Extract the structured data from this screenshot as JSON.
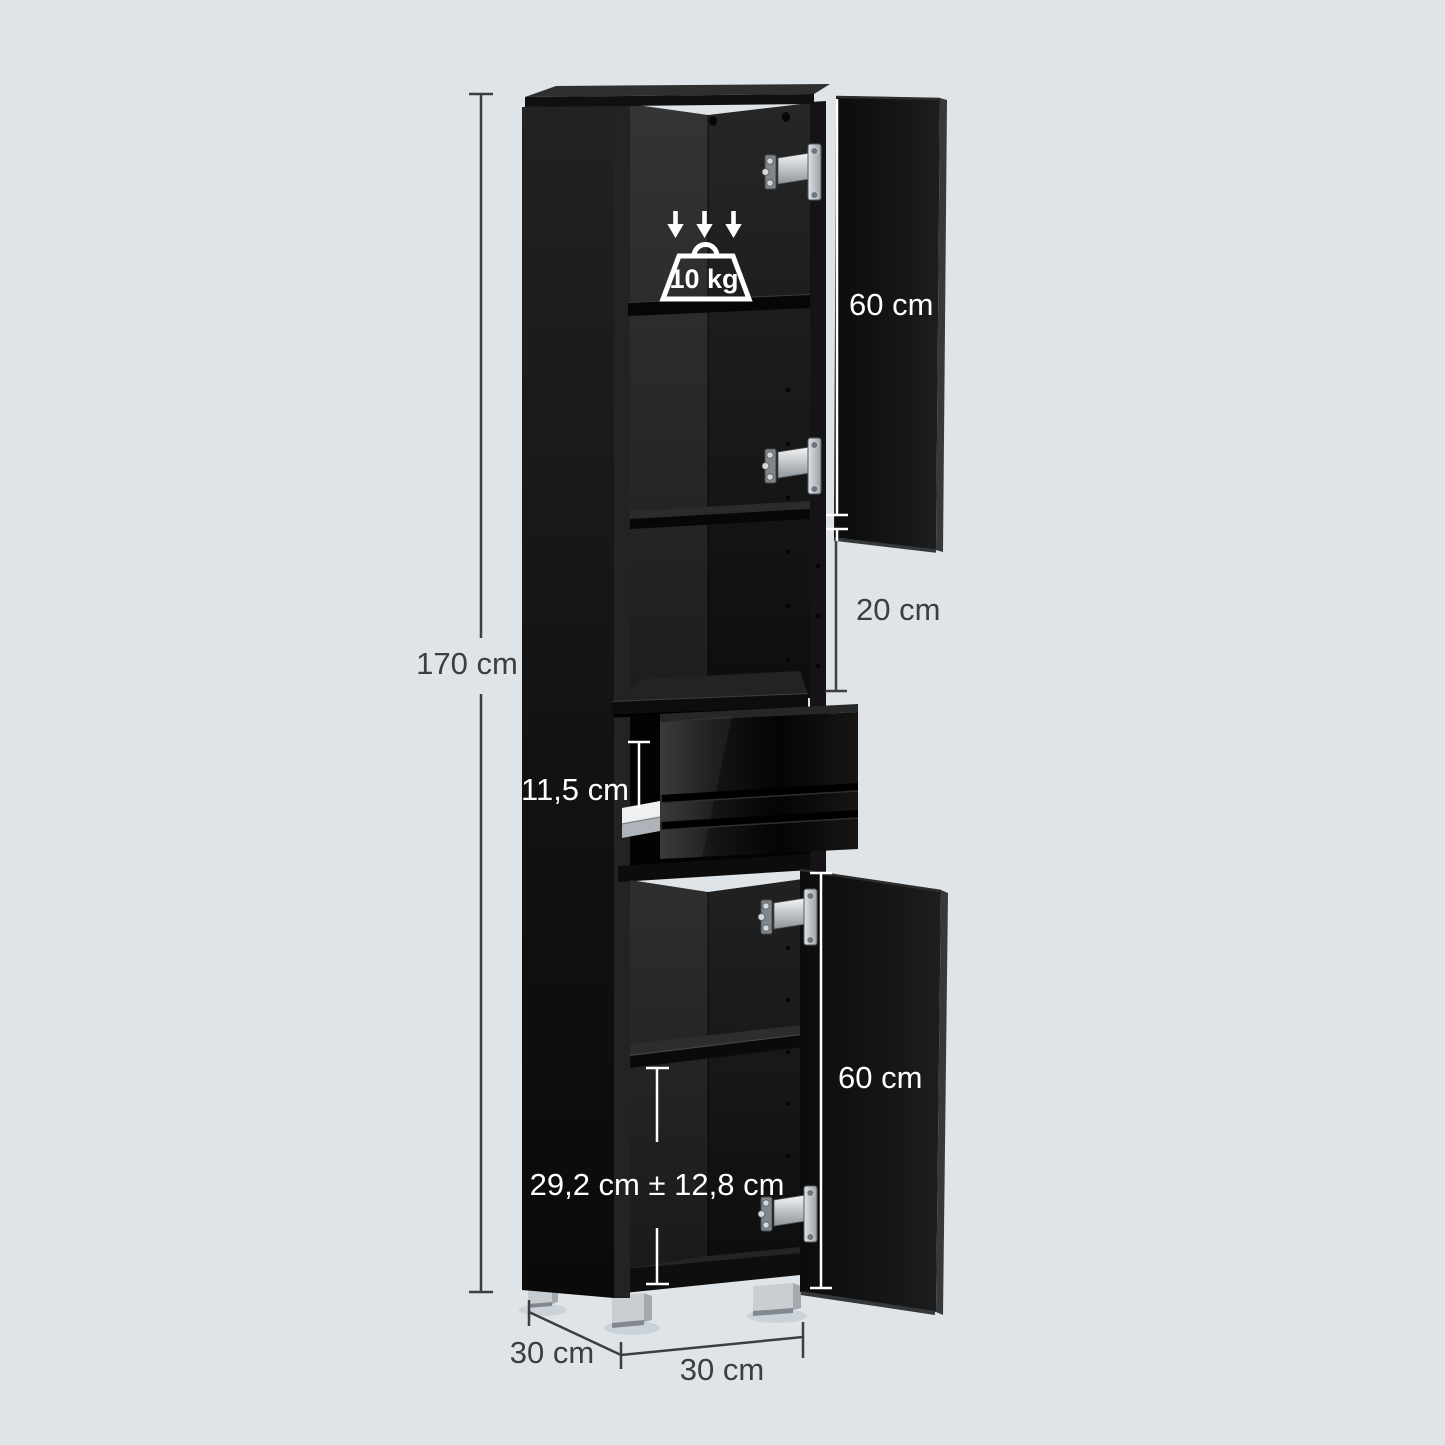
{
  "diagram": {
    "type": "furniture-dimension-diagram",
    "subject": "tall narrow bathroom storage cabinet, black, two open doors and open drawer",
    "background_color": "#dee4e8",
    "cabinet_color": "#121212",
    "dark_line_color": "#3b3f42",
    "light_line_color": "#ffffff",
    "feet_color": "#c7ccd0",
    "hinge_color": "#c9ced3"
  },
  "dimensions": {
    "total_height": "170 cm",
    "upper_door_height": "60 cm",
    "open_compartment_height": "20 cm",
    "drawer_front_height": "11,5 cm",
    "lower_door_height": "60 cm",
    "adjustable_shelf_range": "29,2 cm ± 12,8 cm",
    "depth": "30 cm",
    "width": "30 cm"
  },
  "capacity": {
    "max_shelf_load": "10 kg"
  },
  "icons": {
    "load_arrows": "three-down-arrows",
    "weight": "weight-outline"
  }
}
